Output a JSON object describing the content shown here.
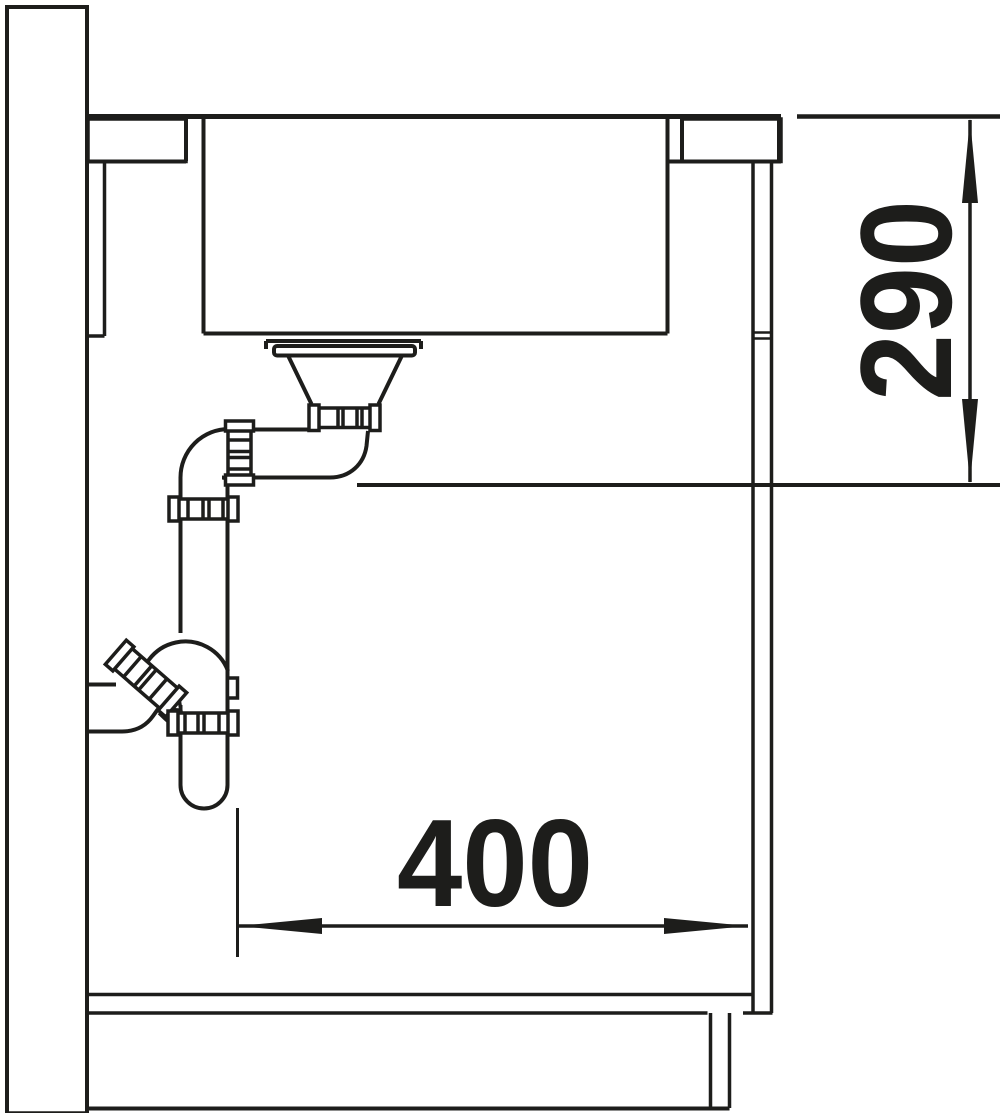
{
  "diagram": {
    "title": "sink-installation-section",
    "dimensions": {
      "depth": {
        "value": "290"
      },
      "width": {
        "value": "400"
      }
    },
    "colors": {
      "ink": "#1d1d1b",
      "background": "#ffffff"
    }
  }
}
